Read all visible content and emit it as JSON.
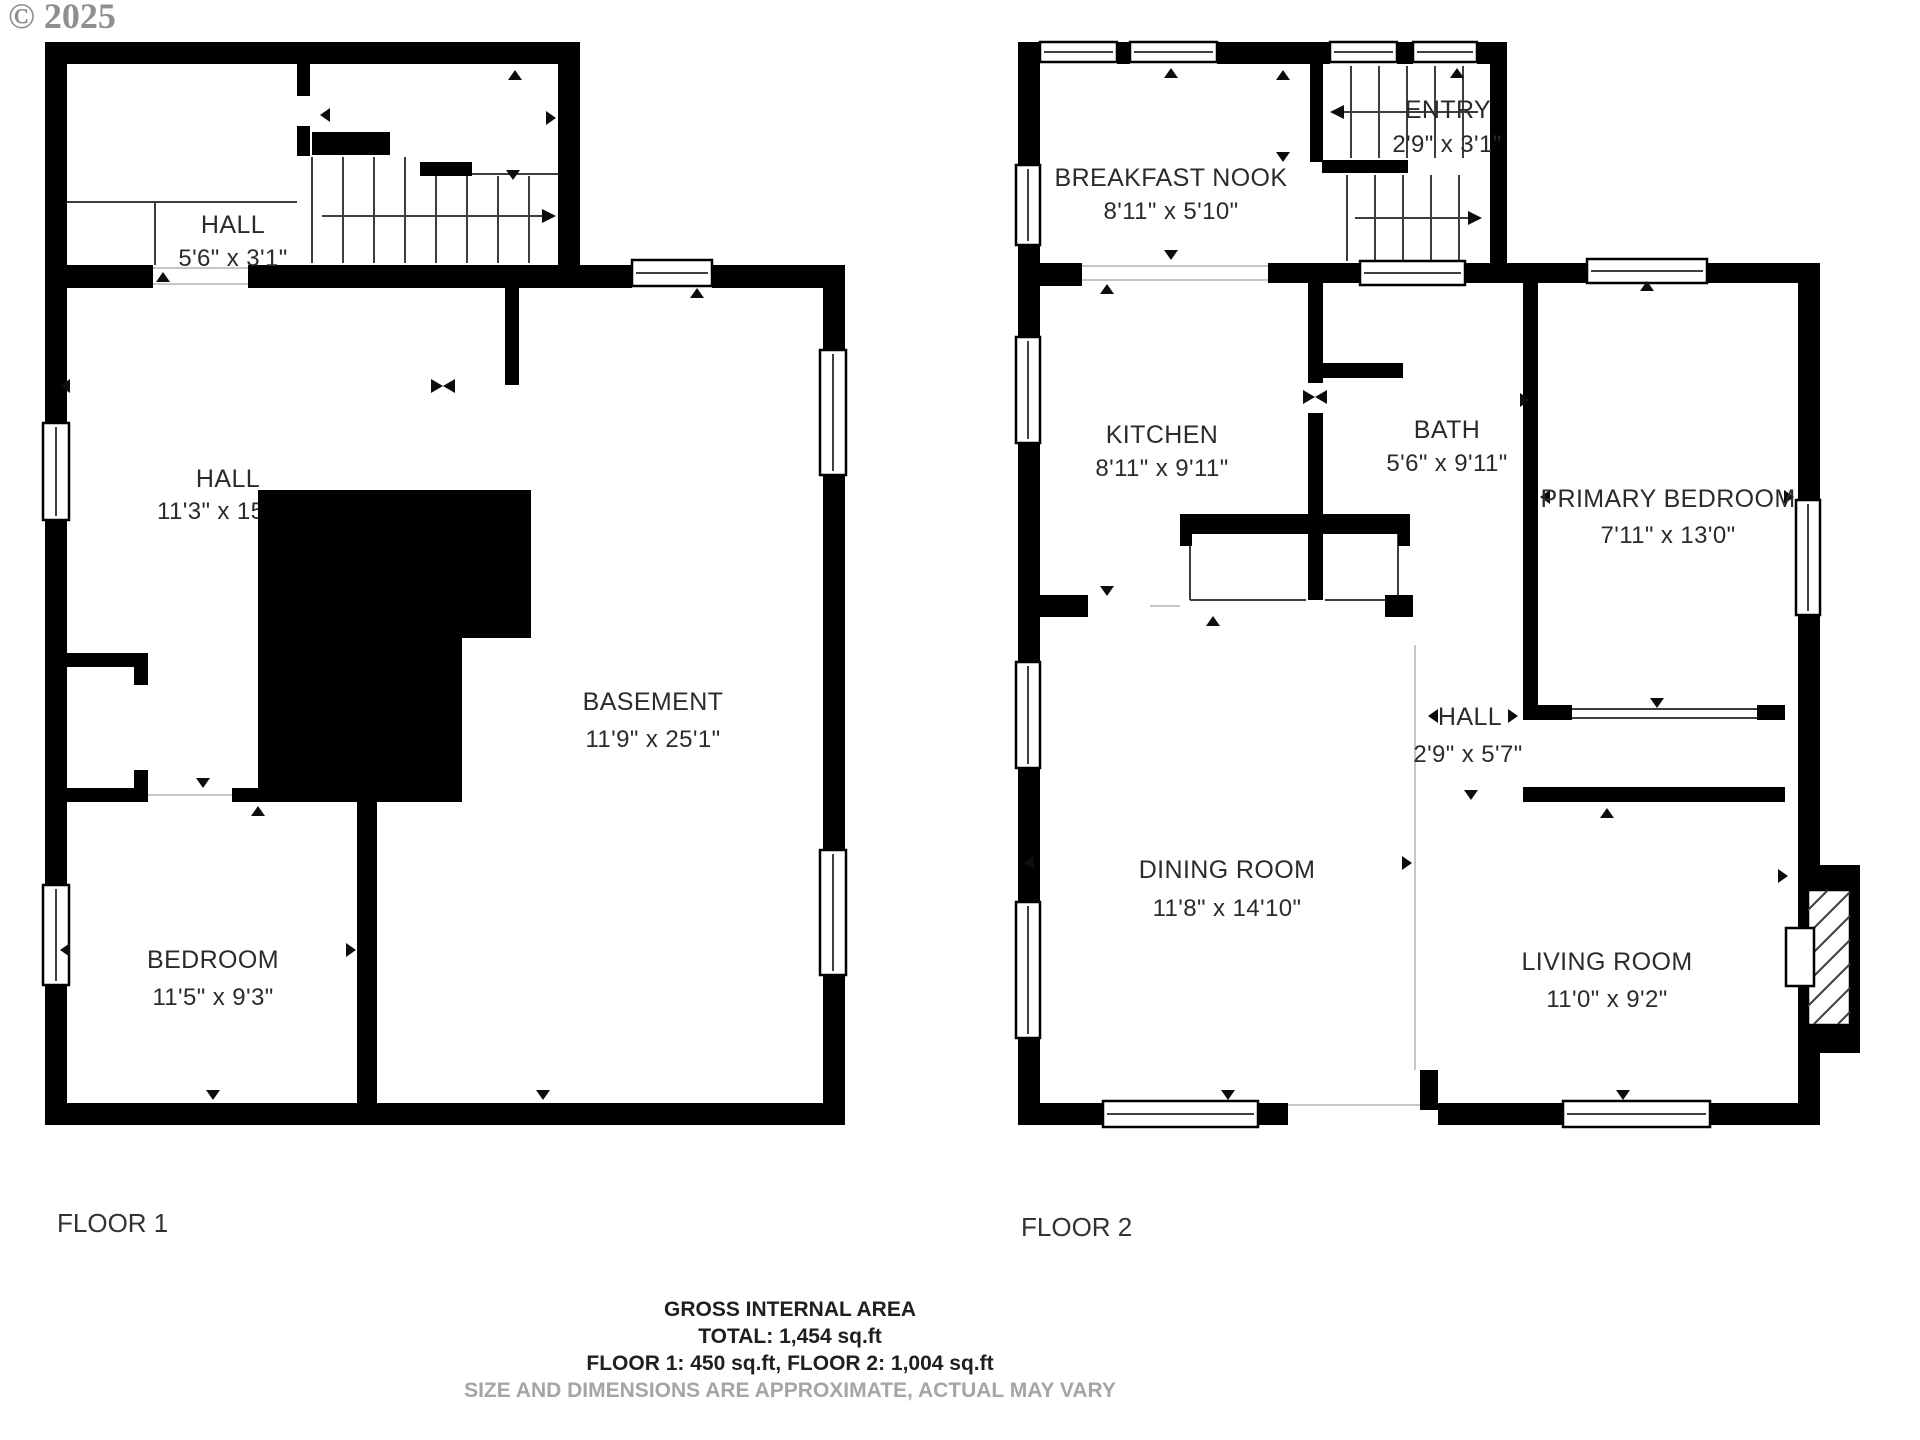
{
  "watermark": "© 2025",
  "floor1": {
    "caption": "FLOOR 1",
    "rooms": {
      "hall_upper": {
        "name": "HALL",
        "dims": "5'6\" x 3'1\""
      },
      "hall_main": {
        "name": "HALL",
        "dims": "11'3\" x 15"
      },
      "basement": {
        "name": "BASEMENT",
        "dims": "11'9\" x 25'1\""
      },
      "bedroom": {
        "name": "BEDROOM",
        "dims": "11'5\" x 9'3\""
      }
    }
  },
  "floor2": {
    "caption": "FLOOR 2",
    "rooms": {
      "breakfast_nook": {
        "name": "BREAKFAST NOOK",
        "dims": "8'11\" x 5'10\""
      },
      "entry": {
        "name": "ENTRY",
        "dims": "2'9\" x 3'1\""
      },
      "kitchen": {
        "name": "KITCHEN",
        "dims": "8'11\" x 9'11\""
      },
      "bath": {
        "name": "BATH",
        "dims": "5'6\" x 9'11\""
      },
      "primary_bedroom": {
        "name": "PRIMARY BEDROOM",
        "dims": "7'11\" x 13'0\""
      },
      "hall": {
        "name": "HALL",
        "dims": "2'9\" x 5'7\""
      },
      "dining_room": {
        "name": "DINING ROOM",
        "dims": "11'8\" x 14'10\""
      },
      "living_room": {
        "name": "LIVING ROOM",
        "dims": "11'0\" x 9'2\""
      }
    }
  },
  "footer": {
    "title": "GROSS INTERNAL AREA",
    "total": "TOTAL: 1,454 sq.ft",
    "floors": "FLOOR 1: 450 sq.ft, FLOOR 2: 1,004 sq.ft",
    "disclaimer": "SIZE AND DIMENSIONS ARE APPROXIMATE, ACTUAL MAY VARY"
  },
  "colors": {
    "wall": "#000000",
    "label": "#2b2b2b",
    "muted": "#a5a5a5"
  }
}
